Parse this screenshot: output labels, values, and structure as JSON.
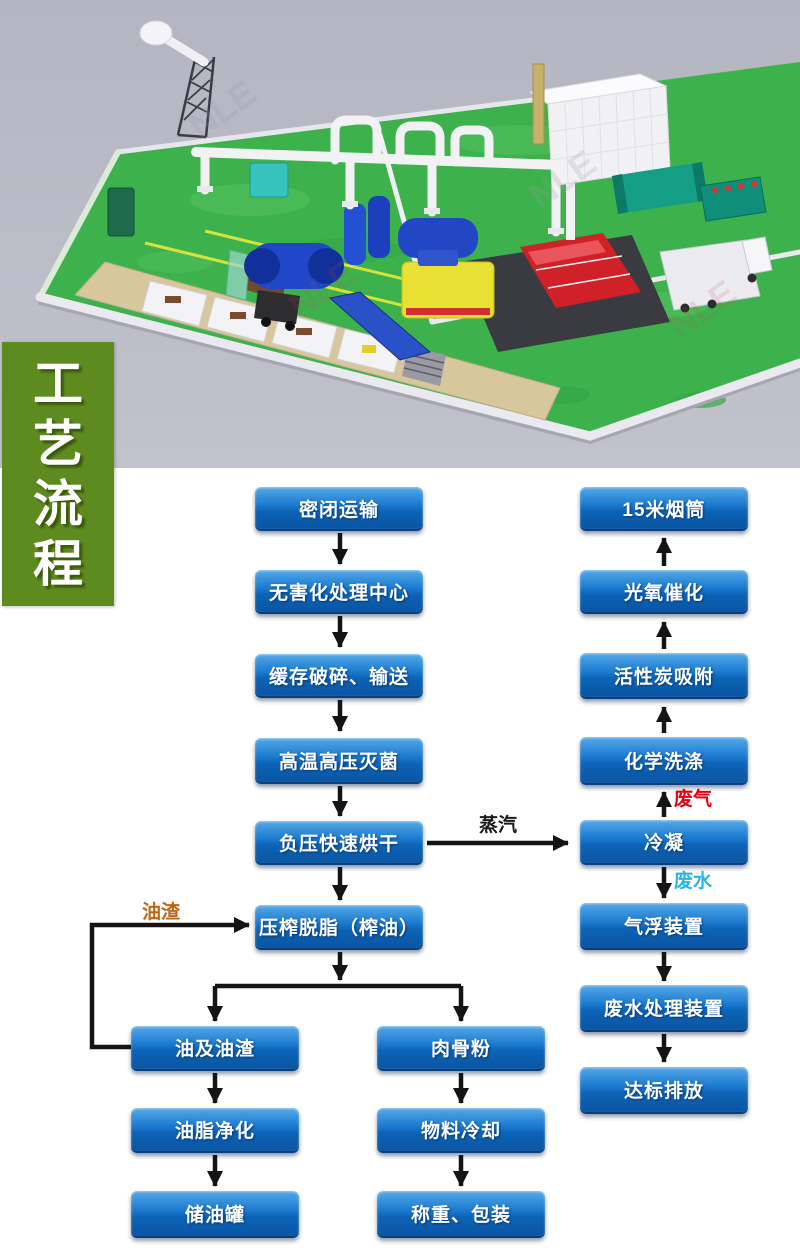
{
  "banner": {
    "text": "工艺流程",
    "chars": [
      "工",
      "艺",
      "流",
      "程"
    ],
    "bg_color": "#5e8b1f",
    "text_color": "#ffffff"
  },
  "scene": {
    "watermark": "NLE",
    "background_color": "#b9bac5",
    "floor_color": "#3db24c"
  },
  "flowchart": {
    "style": {
      "box_gradient_top": "#55a9e7",
      "box_gradient_bottom": "#0a55a2",
      "box_text_color": "#ffffff",
      "arrow_color": "#141414"
    },
    "nodes": [
      {
        "id": "sealed-transport",
        "label": "密闭运输",
        "x": 255,
        "y": 487,
        "w": 168,
        "h": 42
      },
      {
        "id": "treatment-center",
        "label": "无害化处理中心",
        "x": 255,
        "y": 570,
        "w": 168,
        "h": 42
      },
      {
        "id": "buffer-crush-convey",
        "label": "缓存破碎、输送",
        "x": 255,
        "y": 654,
        "w": 168,
        "h": 42
      },
      {
        "id": "high-temp-sterilize",
        "label": "高温高压灭菌",
        "x": 255,
        "y": 738,
        "w": 168,
        "h": 44
      },
      {
        "id": "vacuum-drying",
        "label": "负压快速烘干",
        "x": 255,
        "y": 821,
        "w": 168,
        "h": 42
      },
      {
        "id": "press-degrease",
        "label": "压榨脱脂（榨油）",
        "x": 255,
        "y": 905,
        "w": 168,
        "h": 43
      },
      {
        "id": "oil-and-residue",
        "label": "油及油渣",
        "x": 131,
        "y": 1026,
        "w": 168,
        "h": 43
      },
      {
        "id": "oil-purification",
        "label": "油脂净化",
        "x": 131,
        "y": 1108,
        "w": 168,
        "h": 43
      },
      {
        "id": "oil-storage-tank",
        "label": "储油罐",
        "x": 131,
        "y": 1191,
        "w": 168,
        "h": 45
      },
      {
        "id": "meat-bone-meal",
        "label": "肉骨粉",
        "x": 377,
        "y": 1026,
        "w": 168,
        "h": 43
      },
      {
        "id": "material-cooling",
        "label": "物料冷却",
        "x": 377,
        "y": 1108,
        "w": 168,
        "h": 43
      },
      {
        "id": "weigh-pack",
        "label": "称重、包装",
        "x": 377,
        "y": 1191,
        "w": 168,
        "h": 45
      },
      {
        "id": "chimney-15m",
        "label": "15米烟筒",
        "x": 580,
        "y": 487,
        "w": 168,
        "h": 42
      },
      {
        "id": "photo-oxygen",
        "label": "光氧催化",
        "x": 580,
        "y": 570,
        "w": 168,
        "h": 42
      },
      {
        "id": "activated-carbon",
        "label": "活性炭吸附",
        "x": 580,
        "y": 653,
        "w": 168,
        "h": 44
      },
      {
        "id": "chemical-washing",
        "label": "化学洗涤",
        "x": 580,
        "y": 737,
        "w": 168,
        "h": 46
      },
      {
        "id": "condensation",
        "label": "冷凝",
        "x": 580,
        "y": 820,
        "w": 168,
        "h": 43
      },
      {
        "id": "air-flotation",
        "label": "气浮装置",
        "x": 580,
        "y": 903,
        "w": 168,
        "h": 45
      },
      {
        "id": "wastewater-unit",
        "label": "废水处理装置",
        "x": 580,
        "y": 985,
        "w": 168,
        "h": 45
      },
      {
        "id": "standard-discharge",
        "label": "达标排放",
        "x": 580,
        "y": 1067,
        "w": 168,
        "h": 45
      }
    ],
    "labels": [
      {
        "id": "steam",
        "text": "蒸汽",
        "color": "#1a1a1a",
        "x": 452,
        "y": 810,
        "w": 92,
        "center": true
      },
      {
        "id": "waste-gas",
        "text": "废气",
        "color": "#e60012",
        "x": 674,
        "y": 784
      },
      {
        "id": "waste-water",
        "text": "废水",
        "color": "#2ab4e8",
        "x": 674,
        "y": 866
      },
      {
        "id": "oil-residue",
        "text": "油渣",
        "color": "#bf6516",
        "x": 142,
        "y": 897
      }
    ]
  }
}
